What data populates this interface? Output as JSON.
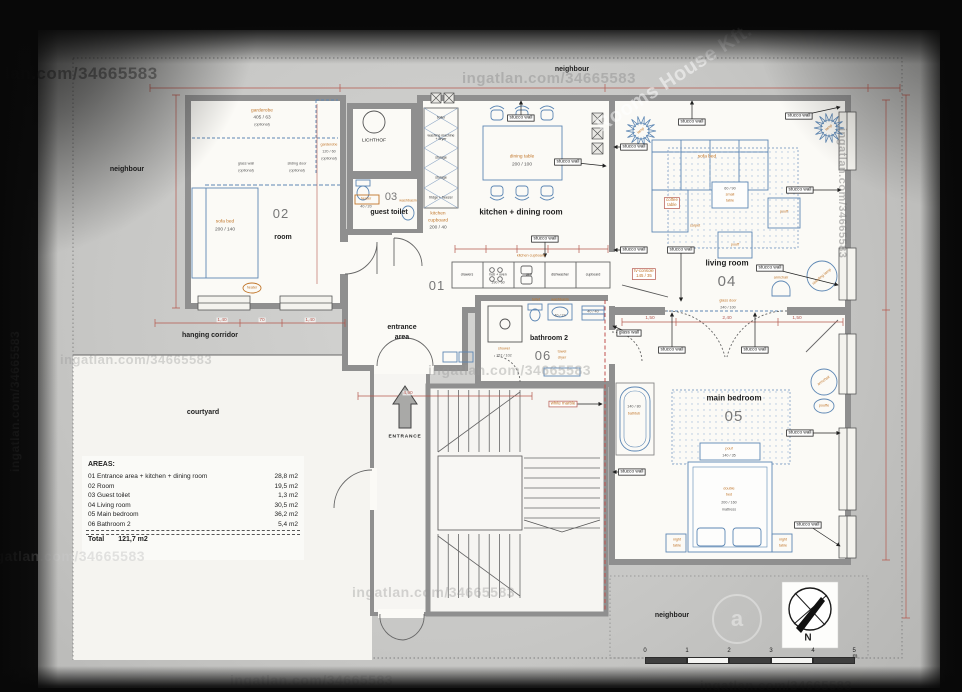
{
  "watermark": {
    "text": "ingatlan.com/34665583",
    "brand": "Rooms House Kft.",
    "logo_glyph": "a"
  },
  "site": {
    "neighbour": "neighbour",
    "hanging_corridor": "hanging corridor",
    "courtyard": "courtyard",
    "entrance_label": "ENTRANCE",
    "lichthof": "LICHTHOF"
  },
  "rooms": {
    "entrance": {
      "num": "01",
      "line1": "entrance",
      "line2": "area"
    },
    "kitchen_dining": {
      "name": "kitchen + dining room"
    },
    "room2": {
      "num": "02",
      "name": "room"
    },
    "guest_toilet": {
      "num": "03",
      "name": "guest toilet"
    },
    "living": {
      "num": "04",
      "name": "living room"
    },
    "bedroom": {
      "num": "05",
      "name": "main bedroom"
    },
    "bathroom2": {
      "num": "06",
      "name": "bathroom 2"
    }
  },
  "labels": {
    "stucco_wall": "stucco wall",
    "glass_wall": "glass wall",
    "stair_note": "white marble"
  },
  "furniture": {
    "garderobe": "garderobe",
    "garderobe1_size": "405 / 63",
    "garderobe2_size": "120 / 60",
    "optional": "(optional)",
    "glass_wall_opt": "glass wall",
    "sliding_door": "sliding door",
    "sofa_bed": "sofa bed",
    "sofa_bed_size": "200 / 140",
    "heater": "heater",
    "heater_size": "40 / 20",
    "washbasin": "washbasin",
    "dining_table": "dining table",
    "dining_table_size": "200 / 100",
    "kitchen_cupboard_1": "kitchen",
    "kitchen_cupboard_2": "cupboard",
    "kitchen_cupboard_size": "200 / 40",
    "kitchen_cupboard_row": "kitchen cupboard",
    "counter_size": "190 / 60",
    "storage_units": [
      "boiler",
      "washing machine + dryer",
      "storage",
      "storage",
      "fridge + freezer"
    ],
    "kitchen_units": [
      "drawers",
      "hob + oven",
      "sink",
      "dishwasher",
      "cupboard"
    ],
    "coffee_table_1": "coffee",
    "coffee_table_2": "table",
    "small_table_size": "60 / 90",
    "small_table_1": "small",
    "small_table_2": "table",
    "carpet": "carpet",
    "pouff": "pouff",
    "tv_console": "tv-console",
    "tv_console_size": "145 / 35",
    "armchair": "armchair",
    "standing_lamp": "standing lamp",
    "lamp": "lamp",
    "glass_door": "glass door",
    "glass_door_size": "240 / 100",
    "bathtub": "bathtub",
    "bathtub_size": "140 / 80",
    "pouf": "pouf",
    "pouf_size": "140 / 35",
    "double_bed_1": "double",
    "double_bed_2": "bed",
    "double_bed_size": "200 / 160",
    "mattress": "mattress",
    "night_table_1": "night",
    "night_table_2": "table",
    "pouffe2": "pouffe",
    "shower": "shower",
    "shower_size": "157 / 102",
    "toilet": "toilet",
    "washbasin_size": "40 / 24",
    "towel_dryer_1": "towel",
    "towel_dryer_2": "dryer",
    "towel_dryer_size": "40 / 40"
  },
  "dims": {
    "a": "1,40",
    "b": "70",
    "c": "1,40",
    "d": "4,90",
    "e": "1,50",
    "f": "1,50",
    "g": "2,40"
  },
  "areas_table": {
    "title": "AREAS:",
    "rows": [
      {
        "label": "01 Entrance area + kitchen + dining room",
        "value": "28,8 m2"
      },
      {
        "label": "02 Room",
        "value": "19,5 m2"
      },
      {
        "label": "03 Guest toilet",
        "value": "1,3 m2"
      },
      {
        "label": "04 Living room",
        "value": "30,5 m2"
      },
      {
        "label": "05 Main bedroom",
        "value": "36,2 m2"
      },
      {
        "label": "06 Bathroom 2",
        "value": "5,4 m2"
      }
    ],
    "total_label": "Total",
    "total_value": "121,7 m2"
  },
  "scalebar": {
    "ticks": [
      "0",
      "1",
      "2",
      "3",
      "4",
      "5 m"
    ]
  },
  "compass": {
    "north": "N"
  }
}
